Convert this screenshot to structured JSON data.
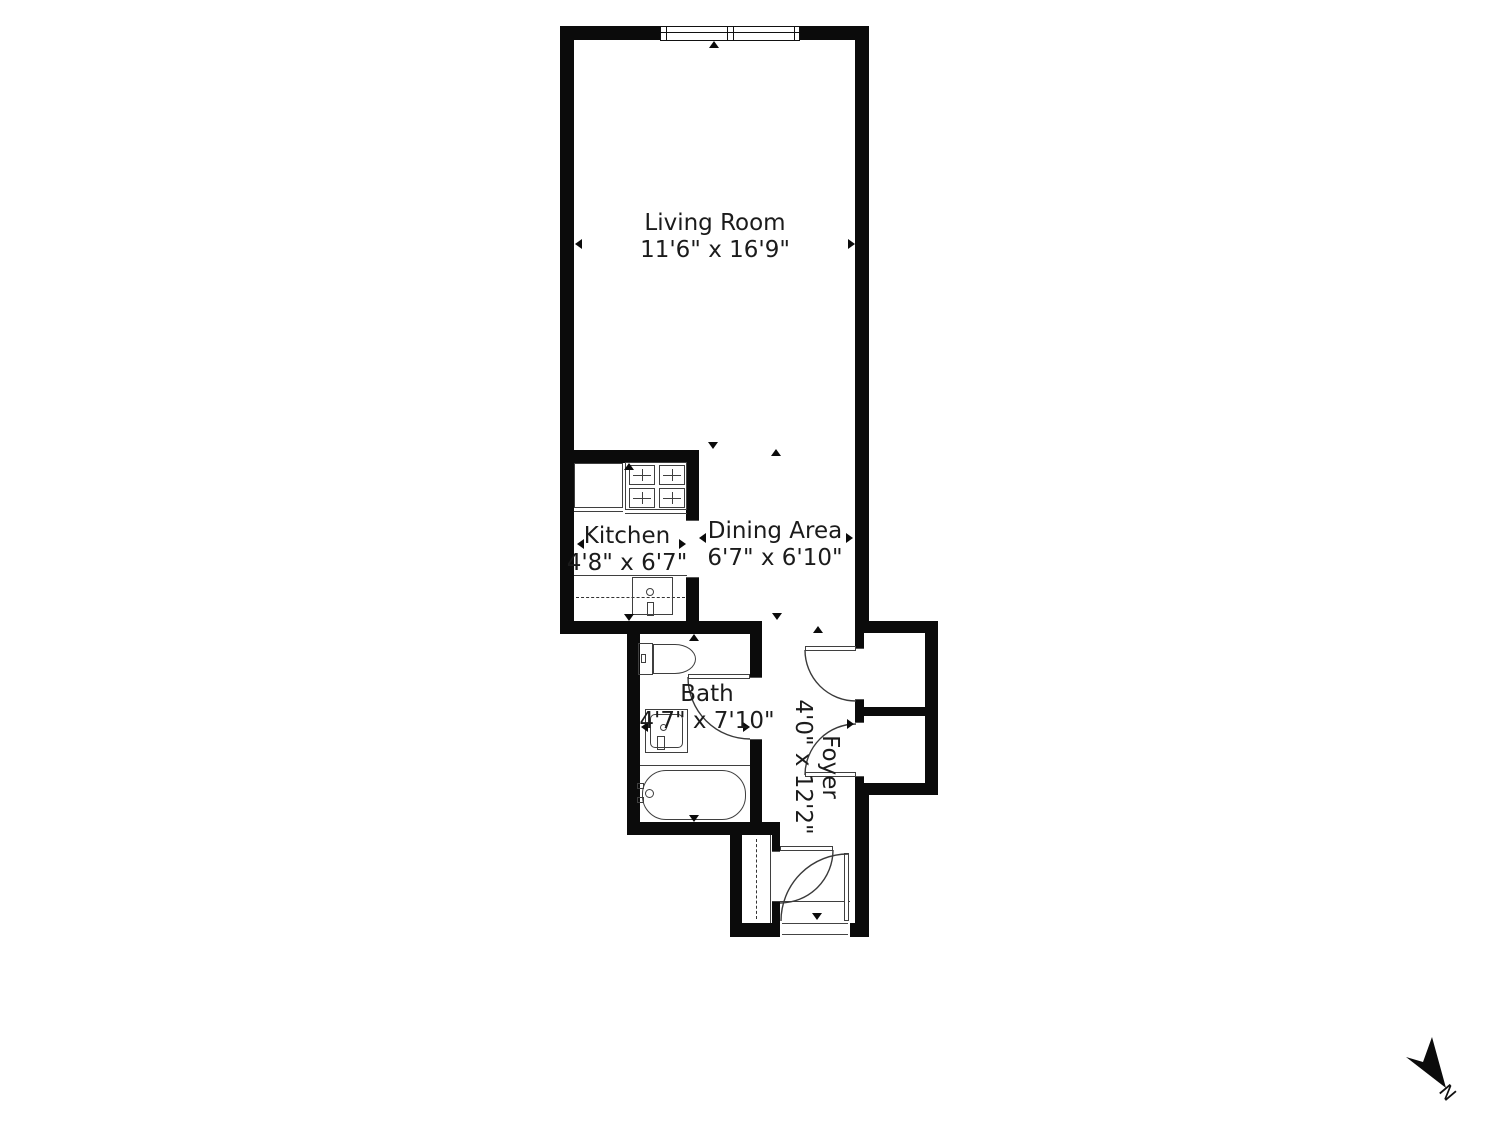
{
  "rooms": {
    "living_room": {
      "name": "Living Room",
      "dimensions": "11'6\" x 16'9\""
    },
    "kitchen": {
      "name": "Kitchen",
      "dimensions": "4'8\" x 6'7\""
    },
    "dining_area": {
      "name": "Dining Area",
      "dimensions": "6'7\" x 6'10\""
    },
    "bath": {
      "name": "Bath",
      "dimensions": "4'7\" x 7'10\""
    },
    "foyer": {
      "name": "Foyer",
      "dimensions": "4'0\" x 12'2\""
    }
  },
  "compass": {
    "label": "N"
  },
  "fixtures": {
    "window": "double-window",
    "stove": "four-burner-stove",
    "refrigerator": "refrigerator",
    "kitchen_sink": "kitchen-sink",
    "toilet": "toilet",
    "bath_sink": "bathroom-sink",
    "bathtub": "bathtub",
    "closets": "two-closets-and-hall-closet"
  },
  "colors": {
    "wall": "#0b0b0b",
    "fixture_line": "#3f3f3f",
    "text": "#1b1b1b",
    "background": "#ffffff"
  }
}
